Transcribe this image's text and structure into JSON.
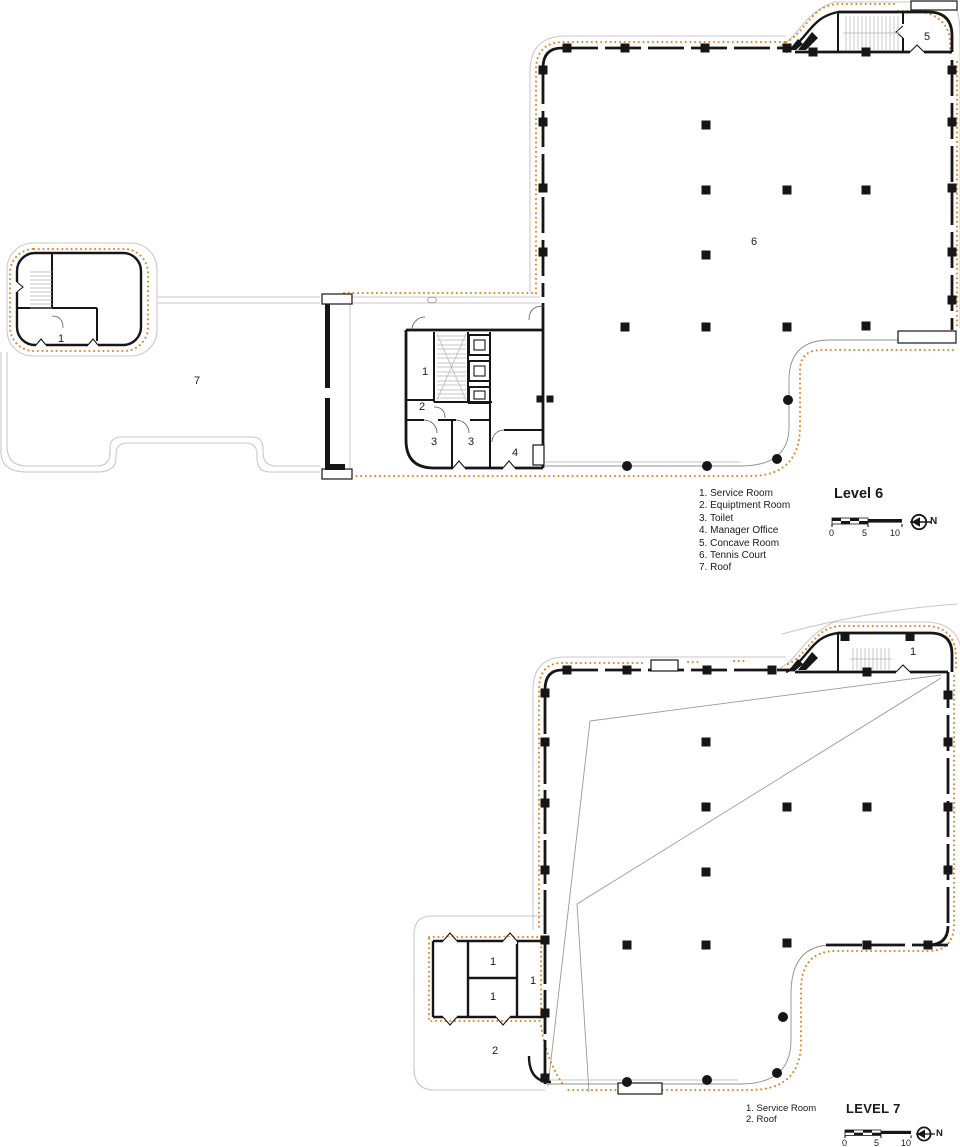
{
  "colors": {
    "envelope_dotted_orange": "#e2821e",
    "wall_black": "#161616",
    "roof_outline_gray": "#c9c9c9"
  },
  "level6": {
    "title": "Level 6",
    "legend": [
      "1. Service Room",
      "2. Equiptment Room",
      "3. Toilet",
      "4. Manager Office",
      "5. Concave Room",
      "6. Tennis Court",
      "7. Roof"
    ],
    "rooms": {
      "left_block_service": "1",
      "roof": "7",
      "core_service": "1",
      "equipment": "2",
      "toilet_a": "3",
      "toilet_b": "3",
      "manager_office": "4",
      "concave_room": "5",
      "tennis_court": "6"
    },
    "scale": {
      "zero": "0",
      "five": "5",
      "ten": "10",
      "north": "N"
    }
  },
  "level7": {
    "title": "LEVEL 7",
    "legend": [
      "1. Service Room",
      "2. Roof"
    ],
    "rooms": {
      "upper_service": "1",
      "service_a": "1",
      "service_b": "1",
      "service_c": "1",
      "roof": "2"
    },
    "scale": {
      "zero": "0",
      "five": "5",
      "ten": "10",
      "north": "N"
    }
  }
}
